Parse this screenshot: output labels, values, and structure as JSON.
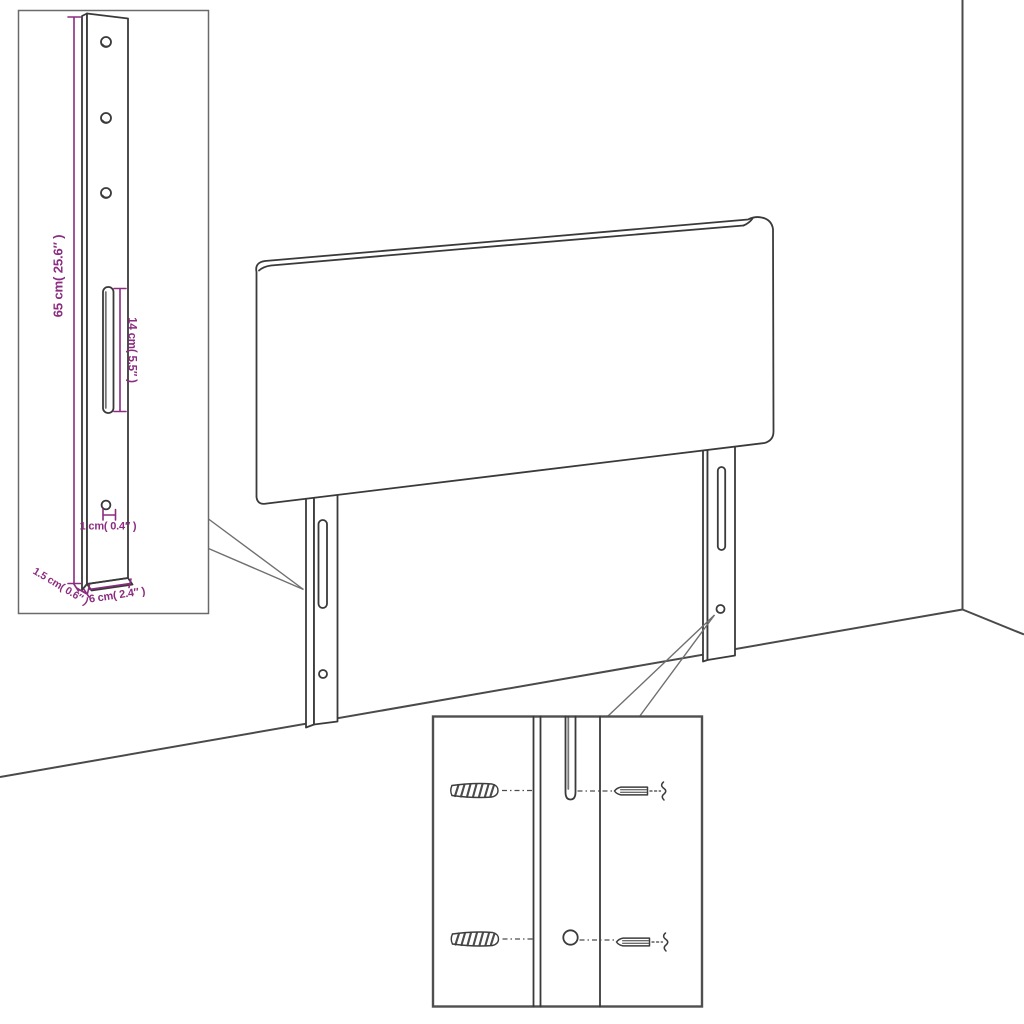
{
  "page": {
    "title": "Headboard with wall-mount legs — dimension diagram"
  },
  "scene": {
    "background_color": "#ffffff",
    "line_color": "#3a3a3a",
    "dimension_color": "#8b2c80",
    "parts": [
      "headboard-panel",
      "left-mounting-leg",
      "right-mounting-leg",
      "wall-corner",
      "floor-line"
    ]
  },
  "leg_detail_inset": {
    "labels": {
      "height": "65 cm( 25.6″ )",
      "slot_length": "14 cm( 5.5″ )",
      "hole_diameter": "1 cm( 0.4″ )",
      "thickness": "1.5 cm( 0.6″ )",
      "width": "6 cm( 2.4″ )"
    }
  },
  "mounting_detail_inset": {
    "icons": [
      "wall-plug-icon",
      "screw-icon"
    ]
  }
}
